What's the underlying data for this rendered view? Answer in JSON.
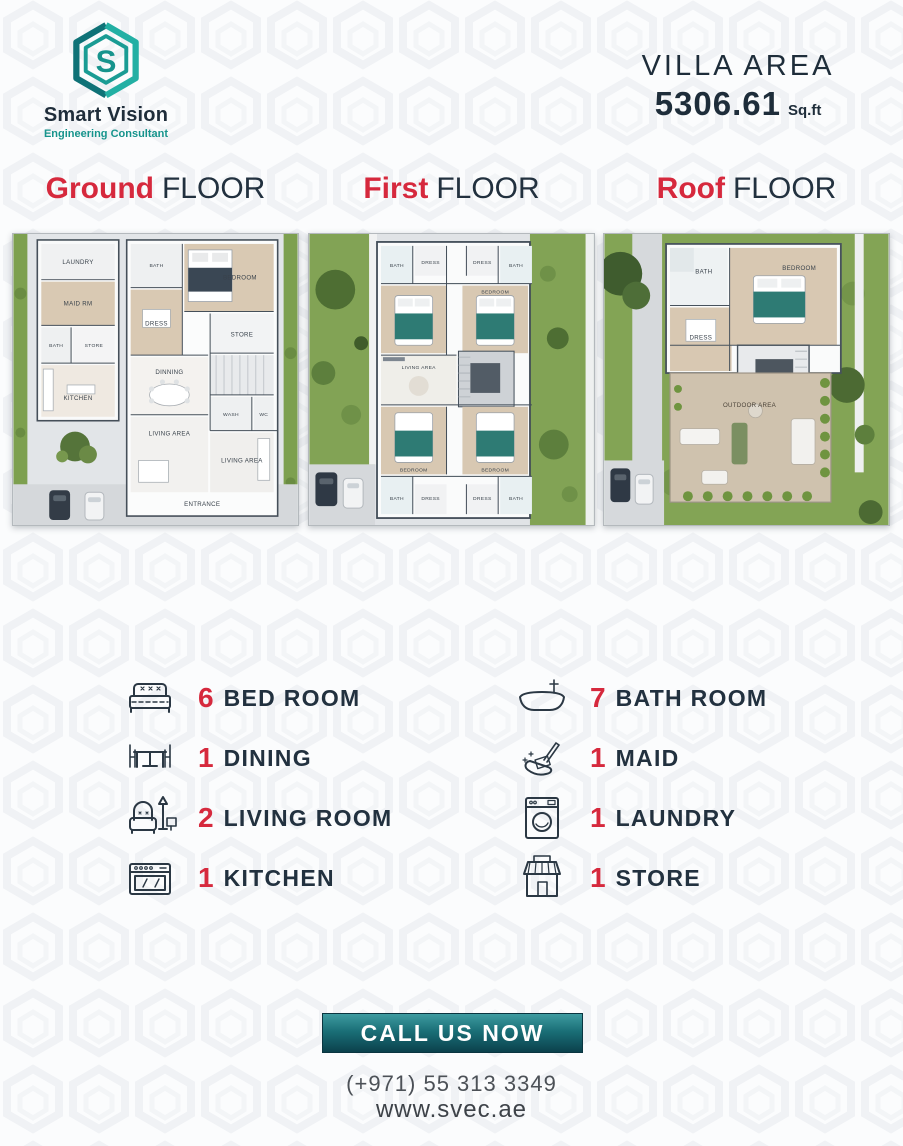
{
  "brand": {
    "name": "Smart Vision",
    "tagline": "Engineering Consultant",
    "monogram": "S"
  },
  "villa_area": {
    "label": "VILLA AREA",
    "value": "5306.61",
    "unit": "Sq.ft"
  },
  "floors": [
    {
      "title_accent": "Ground",
      "title_rest": "FLOOR",
      "rooms": [
        "LAUNDRY",
        "MAID RM",
        "BATH",
        "STORE",
        "KITCHEN",
        "BATH",
        "BEDROOM",
        "DRESS",
        "STORE",
        "DINNING",
        "WASH",
        "WC",
        "LIVING AREA",
        "LIVING AREA",
        "ENTRANCE"
      ]
    },
    {
      "title_accent": "First",
      "title_rest": "FLOOR",
      "rooms": [
        "BATH",
        "DRESS",
        "DRESS",
        "BATH",
        "BEDROOM",
        "LIVING AREA",
        "BEDROOM",
        "BEDROOM",
        "BATH",
        "DRESS",
        "DRESS",
        "BATH"
      ]
    },
    {
      "title_accent": "Roof",
      "title_rest": "FLOOR",
      "rooms": [
        "BATH",
        "BEDROOM",
        "DRESS",
        "OUTDOOR AREA"
      ]
    }
  ],
  "stats": {
    "left": [
      {
        "count": "6",
        "label": "BED ROOM",
        "icon": "bed-icon"
      },
      {
        "count": "1",
        "label": "DINING",
        "icon": "dining-table-icon"
      },
      {
        "count": "2",
        "label": "LIVING ROOM",
        "icon": "armchair-lamp-icon"
      },
      {
        "count": "1",
        "label": "KITCHEN",
        "icon": "stove-icon"
      }
    ],
    "right": [
      {
        "count": "7",
        "label": "BATH ROOM",
        "icon": "bathtub-icon"
      },
      {
        "count": "1",
        "label": "MAID",
        "icon": "dustpan-icon"
      },
      {
        "count": "1",
        "label": "LAUNDRY",
        "icon": "washing-machine-icon"
      },
      {
        "count": "1",
        "label": "STORE",
        "icon": "storefront-icon"
      }
    ]
  },
  "cta": {
    "button": "CALL US NOW",
    "phone": "(+971) 55 313 3349",
    "website": "www.svec.ae"
  },
  "colors": {
    "accent_red": "#d6293d",
    "dark_navy": "#22313f",
    "teal": "#17948d",
    "teal_dark": "#0b414c",
    "grass": "#82a355",
    "bed_teal": "#2e7b74"
  }
}
